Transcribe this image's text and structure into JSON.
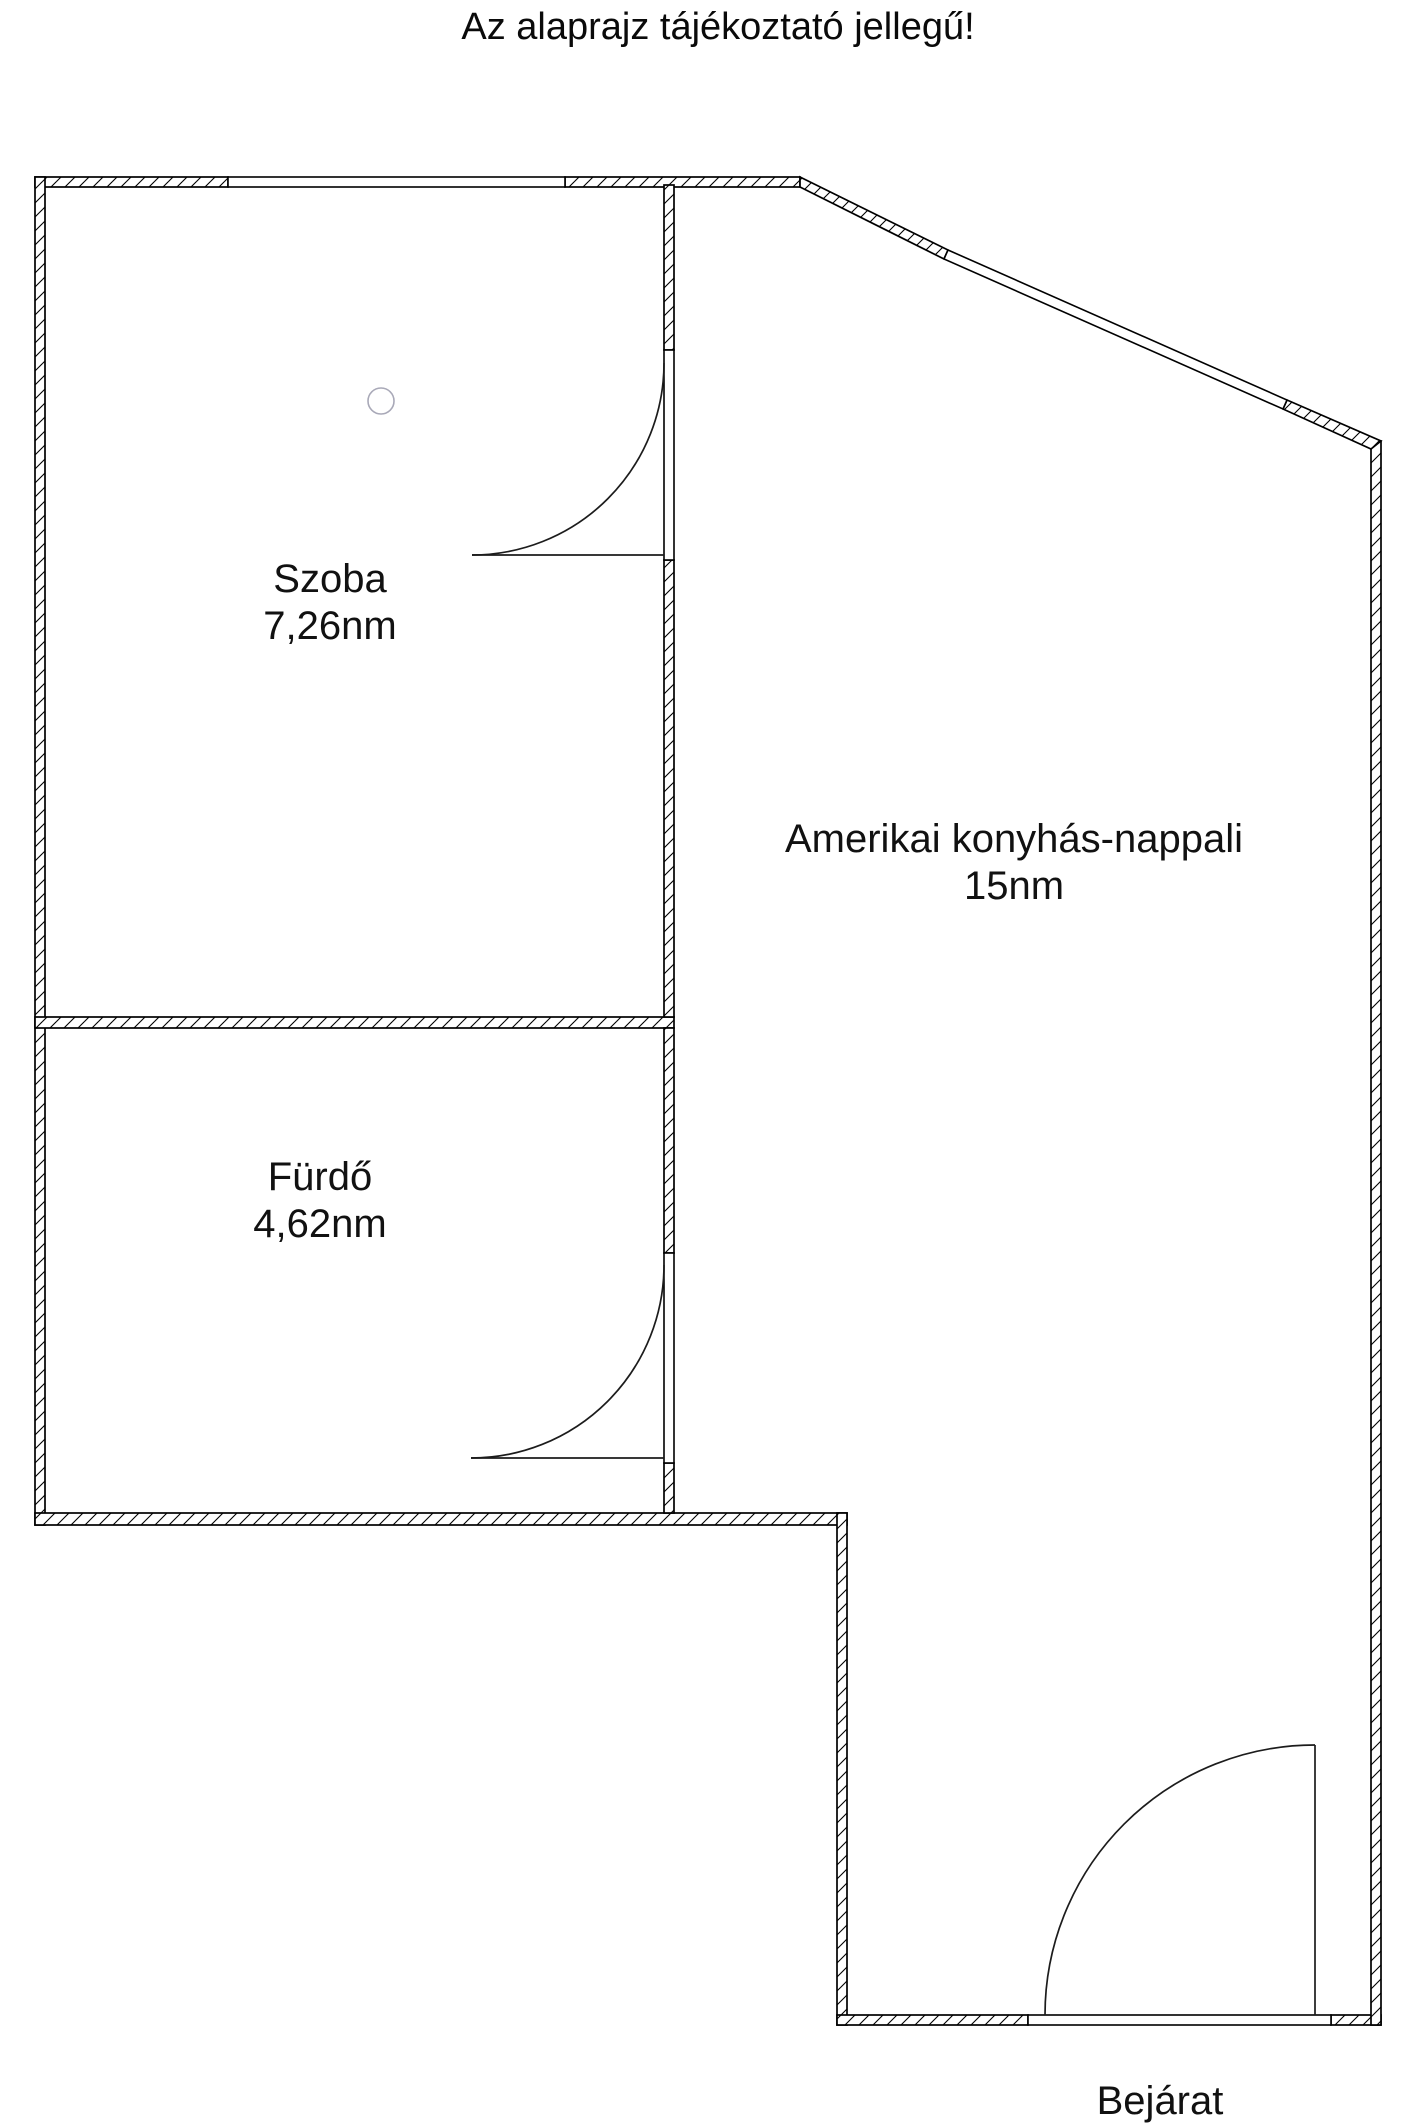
{
  "title": "Az alaprajz tájékoztató jellegű!",
  "rooms": [
    {
      "name": "Szoba",
      "area": "7,26nm"
    },
    {
      "name": "Amerikai konyhás-nappali",
      "area": "15nm"
    },
    {
      "name": "Fürdő",
      "area": "4,62nm"
    }
  ],
  "entrance_label": "Bejárat",
  "colors": {
    "wall_line": "#000000",
    "background": "#ffffff",
    "lamp_symbol": "#a9a9b8",
    "text": "#111111"
  }
}
